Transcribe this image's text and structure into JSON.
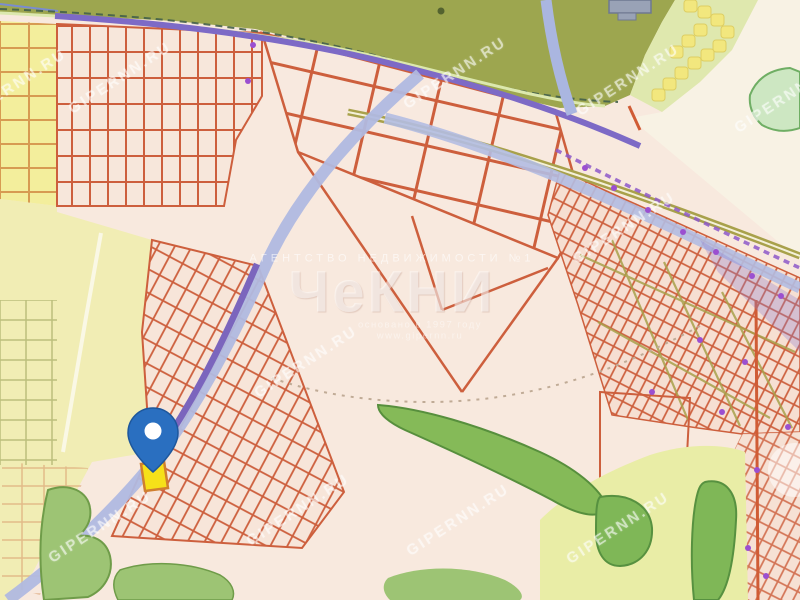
{
  "watermark": {
    "site": "GIPERNN.RU"
  },
  "stamp": {
    "caption": "агентство недвижимости №1",
    "logo": "ЧеКНИ",
    "line1": "основано в 1997 году",
    "line2": "www.gipernn.ru"
  },
  "map": {
    "marker_color": "#2a6fc0",
    "selected_lot_color": "#f6e019",
    "parcel_outline_color": "#cd5f3d",
    "road_colors": {
      "purple": "#7d6ac6",
      "lavender": "#b0b9e0",
      "khaki": "#a8a14b",
      "boundary_dashed": "#8d58c9"
    },
    "area_colors": {
      "background": "#f8e9de",
      "fields": "#f1edb4",
      "forest_belt": "#9da64f",
      "greenery": "#85ba58",
      "cream": "#f8f2e4"
    }
  }
}
